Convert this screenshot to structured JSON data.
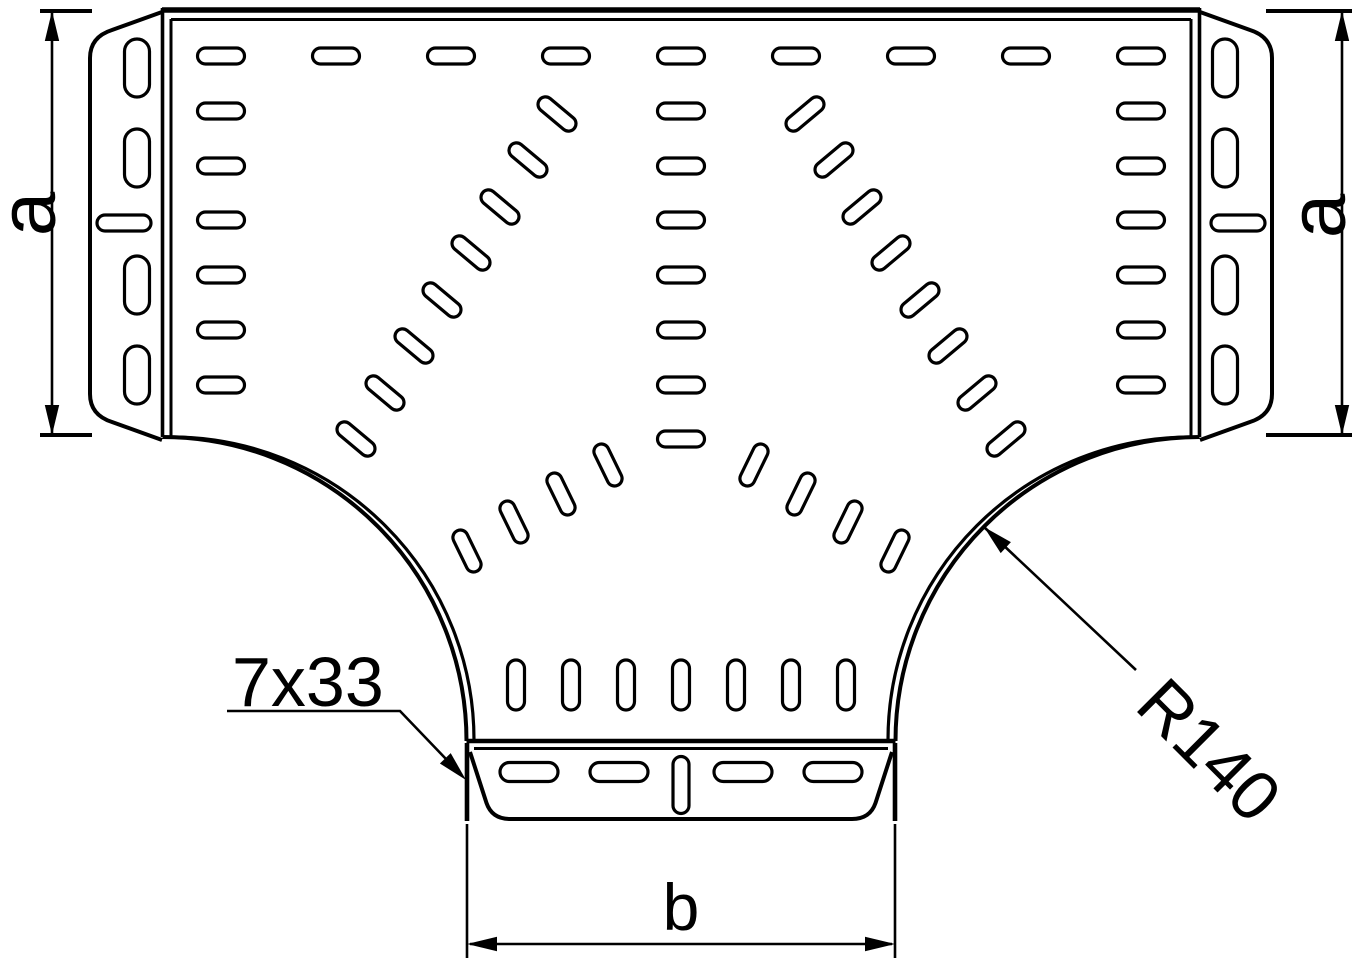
{
  "drawing": {
    "type": "technical-drawing",
    "subject": "Perforated cable tray T-piece (tee), top view",
    "labels": {
      "dim_left": "a",
      "dim_right": "a",
      "dim_bottom": "b",
      "perforation_callout": "7x33",
      "radius_callout": "R140"
    },
    "colors": {
      "line": "#000000",
      "background": "#ffffff"
    }
  }
}
